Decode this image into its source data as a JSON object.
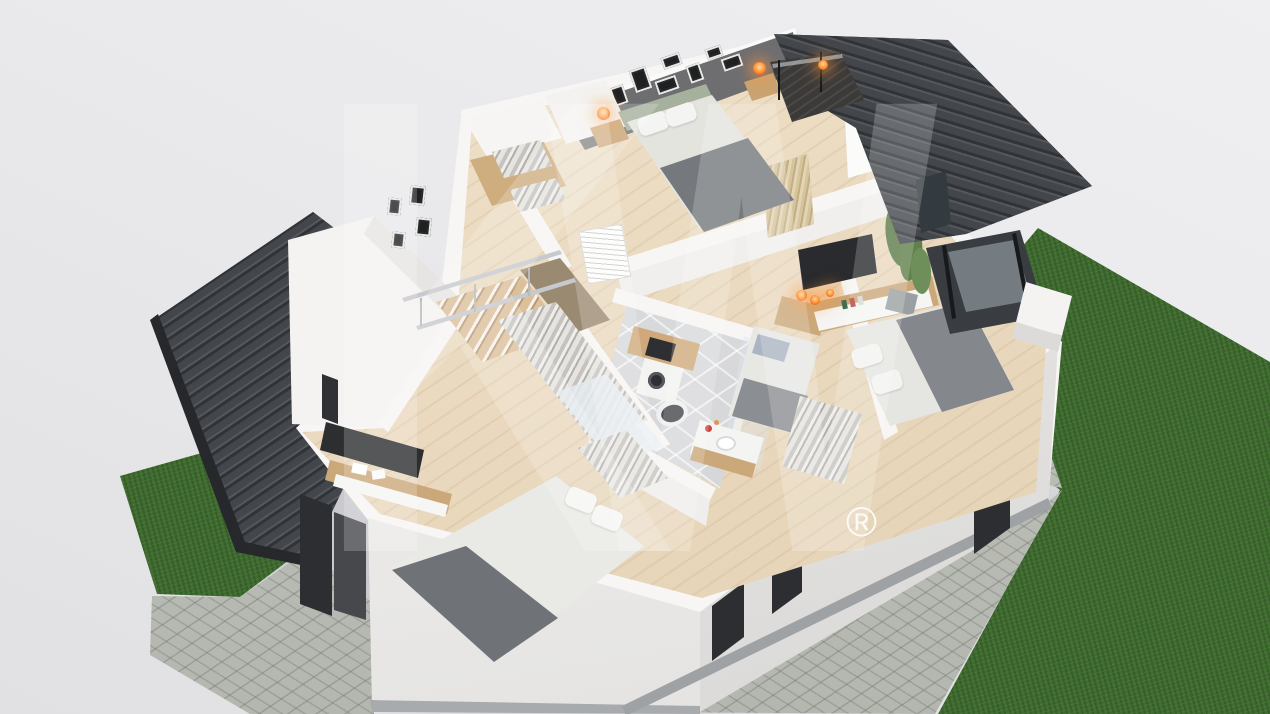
{
  "scene": {
    "type": "3d-floorplan-dollhouse-render",
    "watermark": {
      "letter_k": "K",
      "letter_w": "W",
      "registered": "®"
    },
    "palette": {
      "background": "#e9e9eb",
      "roof": "#43464b",
      "roof_ridge_dark": "#303337",
      "wall_white": "#f7f6f4",
      "accent_wall": "#6b6b6e",
      "floor_wood": "#ecdcc3",
      "floor_tile": "#d7d8da",
      "grass": "#3f6c2f",
      "pavement": "#bcbfb7",
      "wood_furniture": "#cba87a",
      "bed_gray": "#84878b",
      "bed_white": "#e9e9e5",
      "headboard_green": "#a5b09d",
      "lamp_orange": "#ff9a3c",
      "plant_green": "#5c7b49",
      "dark_window": "#2c2e31",
      "glass": "#aebfc9",
      "watermark_white": "rgba(255,255,255,0.2)"
    }
  }
}
